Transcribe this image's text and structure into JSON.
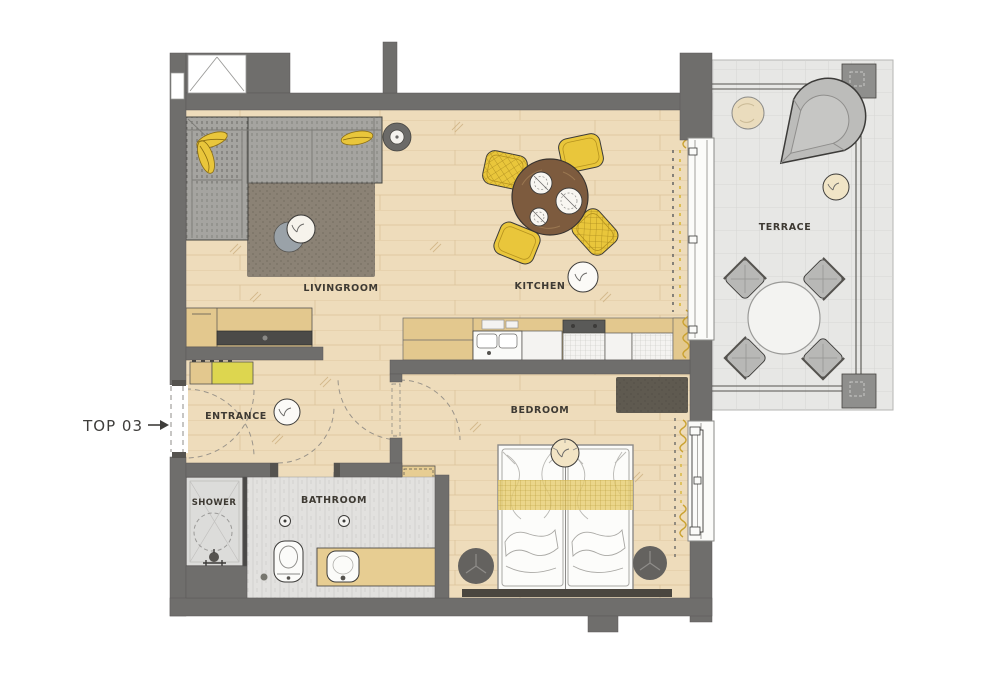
{
  "plan": {
    "unit_label": "TOP 03",
    "rooms": {
      "livingroom": {
        "label": "LIVINGROOM"
      },
      "kitchen": {
        "label": "KITCHEN"
      },
      "entrance": {
        "label": "ENTRANCE"
      },
      "bedroom": {
        "label": "BEDROOM"
      },
      "bathroom": {
        "label": "BATHROOM"
      },
      "shower": {
        "label": "SHOWER"
      },
      "terrace": {
        "label": "TERRACE"
      }
    },
    "colors": {
      "wall_gray": "#6f6e6c",
      "floor_wood": "#eedcbb",
      "floor_wood_line": "#c9a977",
      "bathroom_tile": "#e2e1df",
      "terrace_tile": "#e7e7e5",
      "terrace_grid": "#d2d2d0",
      "accent_yellow": "#e9c63b",
      "bench_yellow": "#ddd64f",
      "curtain_yellow": "#caa231",
      "sofa_gray": "#a5a4a0",
      "rug_brown": "#8b8275",
      "bedroom_rug": "#5f5a50",
      "table_wood": "#7d5b3e",
      "cabinet_wood": "#e3c88e",
      "bed_white": "#fbfbf9",
      "outline_dark": "#3c3b39"
    }
  }
}
